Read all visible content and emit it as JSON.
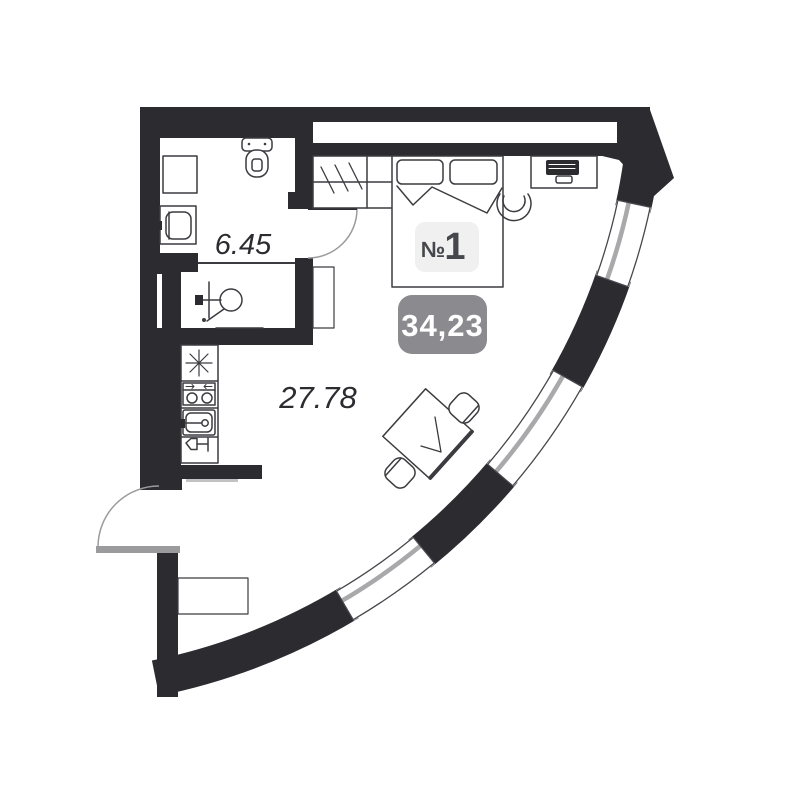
{
  "plan": {
    "unit_badge": {
      "prefix": "№",
      "number": "1"
    },
    "total_area": "34,23",
    "room_areas": {
      "bathroom": "6.45",
      "main_room": "27.78"
    },
    "colors": {
      "wall": "#2b2b30",
      "label_text": "#2b2b30",
      "window_glass": "#a9a9ac",
      "door_swing": "#9b9b9e",
      "threshold": "#c2c2c4",
      "furniture": "#3c3c40",
      "unit_badge_bg": "#f0f0f1",
      "unit_badge_text": "#46474c",
      "area_badge_bg": "#8b8b8f",
      "area_badge_text": "#ffffff"
    },
    "fixtures": [
      "toilet",
      "bathroom-cabinet",
      "washing-machine",
      "shower-mixer",
      "wardrobe",
      "bed",
      "desk",
      "laptop",
      "desk-chair",
      "dining-table",
      "dining-chair",
      "cooker-hood",
      "stove",
      "kitchen-sink",
      "wine-glass-cabinet",
      "shoe-cabinet",
      "entrance-door",
      "bathroom-door",
      "curved-window-wall"
    ]
  }
}
